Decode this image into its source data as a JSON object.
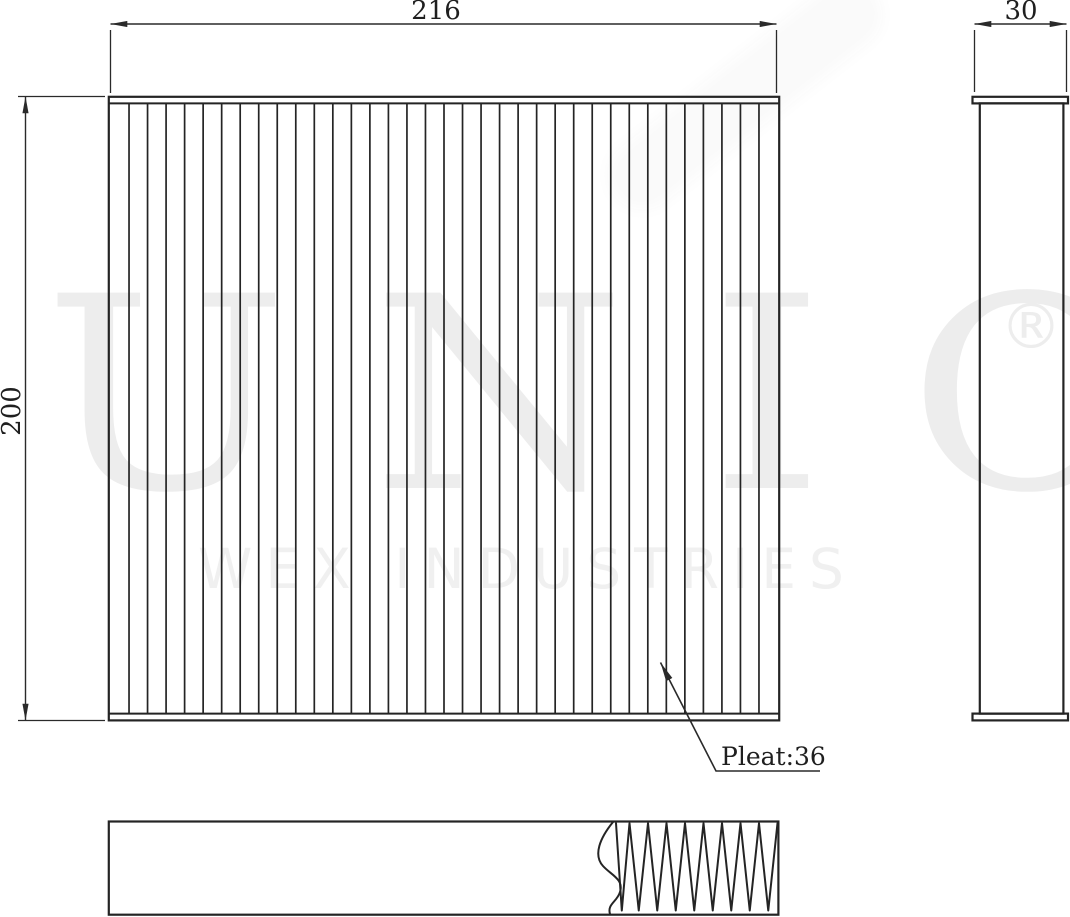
{
  "drawing": {
    "dimensions": {
      "width": "216",
      "height": "200",
      "depth": "30"
    },
    "pleat_callout": "Pleat:36",
    "pleat_count": 36,
    "section_pleat_teeth": 9
  },
  "watermark": {
    "brand": "UNIO",
    "registered": "®",
    "subtitle": "WEX INDUSTRIES"
  },
  "colors": {
    "line": "#242424",
    "dimension_line": "#2a2a2a",
    "watermark_brand": "#ededed",
    "watermark_subtitle": "#f0f0f0",
    "background": "#ffffff"
  }
}
